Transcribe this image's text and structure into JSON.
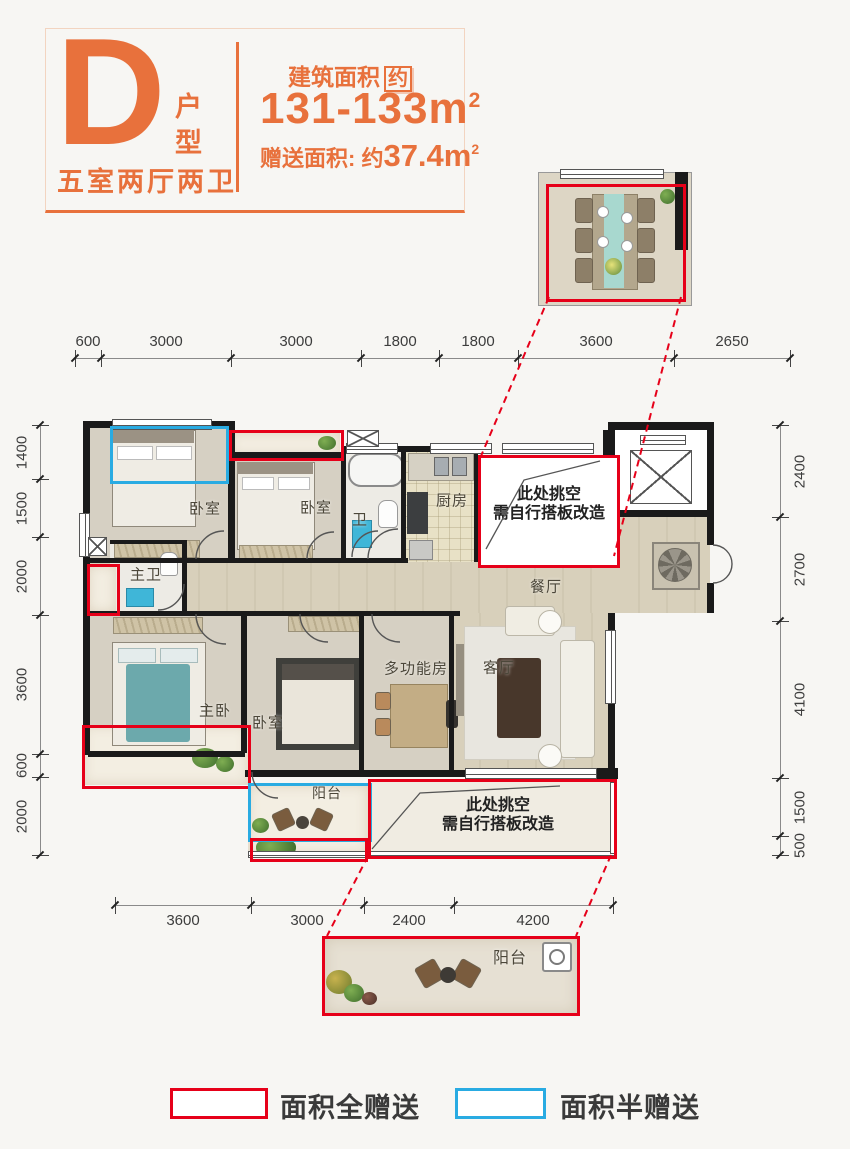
{
  "header": {
    "unit_letter": "D",
    "unit_type": "户型",
    "rooms_spec": "五室两厅两卫",
    "area_label": "建筑面积",
    "area_approx": "约",
    "area_value": "131-133m",
    "area_sup": "2",
    "gift_label": "赠送面积: 约",
    "gift_value": "37.4m",
    "gift_sup": "2"
  },
  "dims": {
    "top": [
      "600",
      "3000",
      "3000",
      "1800",
      "1800",
      "3600",
      "2650"
    ],
    "left": [
      "1400",
      "1500",
      "2000",
      "3600",
      "600",
      "2000"
    ],
    "right": [
      "2400",
      "2700",
      "4100",
      "1500",
      "500"
    ],
    "bottom": [
      "3600",
      "3000",
      "2400",
      "4200"
    ]
  },
  "rooms": {
    "bedroom1": "卧室",
    "bedroom2": "卧室",
    "bath": "卫",
    "kitchen": "厨房",
    "master_bath": "主卫",
    "dining": "餐厅",
    "master_bedroom": "主卧",
    "bedroom3": "卧室",
    "multi_function": "多功能房",
    "living": "客厅",
    "balcony": "阳台"
  },
  "notes": {
    "void_line1": "此处挑空",
    "void_line2": "需自行搭板改造"
  },
  "inset": {
    "balcony_label": "阳台"
  },
  "legend": {
    "full_gift": "面积全赠送",
    "half_gift": "面积半赠送"
  },
  "colors": {
    "orange": "#e8713c",
    "red": "#e60019",
    "blue": "#29abe2",
    "wall": "#1a1a1a"
  }
}
